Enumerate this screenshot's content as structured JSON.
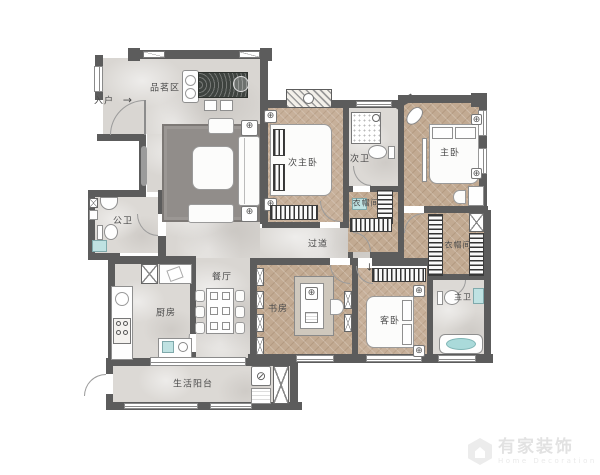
{
  "entry": {
    "label": "入户",
    "arrow": "→"
  },
  "rooms": {
    "tea_area": {
      "label": "品茗区"
    },
    "public_bath": {
      "label": "公卫"
    },
    "kitchen": {
      "label": "厨房"
    },
    "dining": {
      "label": "餐厅"
    },
    "corridor": {
      "label": "过道"
    },
    "balcony": {
      "label": "生活阳台"
    },
    "study": {
      "label": "书房"
    },
    "guest_bedroom": {
      "label": "客卧"
    },
    "master_bath": {
      "label": "主卫"
    },
    "master_bedroom": {
      "label": "主卧"
    },
    "secondary_master_bedroom": {
      "label": "次主卧"
    },
    "secondary_bath": {
      "label": "次卫"
    },
    "closet_a": {
      "label": "衣帽间"
    },
    "closet_b": {
      "label": "衣帽间"
    }
  },
  "icons": {
    "fixture": "⊕",
    "washer": "⊘",
    "arrow_down": "↓"
  },
  "watermark": {
    "brand": "有家装饰",
    "subtitle": "Home Decoration"
  },
  "colors": {
    "wall": "#5c5c5c",
    "marble_floor": "#d9d6d2",
    "wood_floor": "#c2aa92",
    "tile_floor": "#dcd9d5",
    "accent_teal": "#bfe2e2",
    "rug": "#918d8a"
  }
}
